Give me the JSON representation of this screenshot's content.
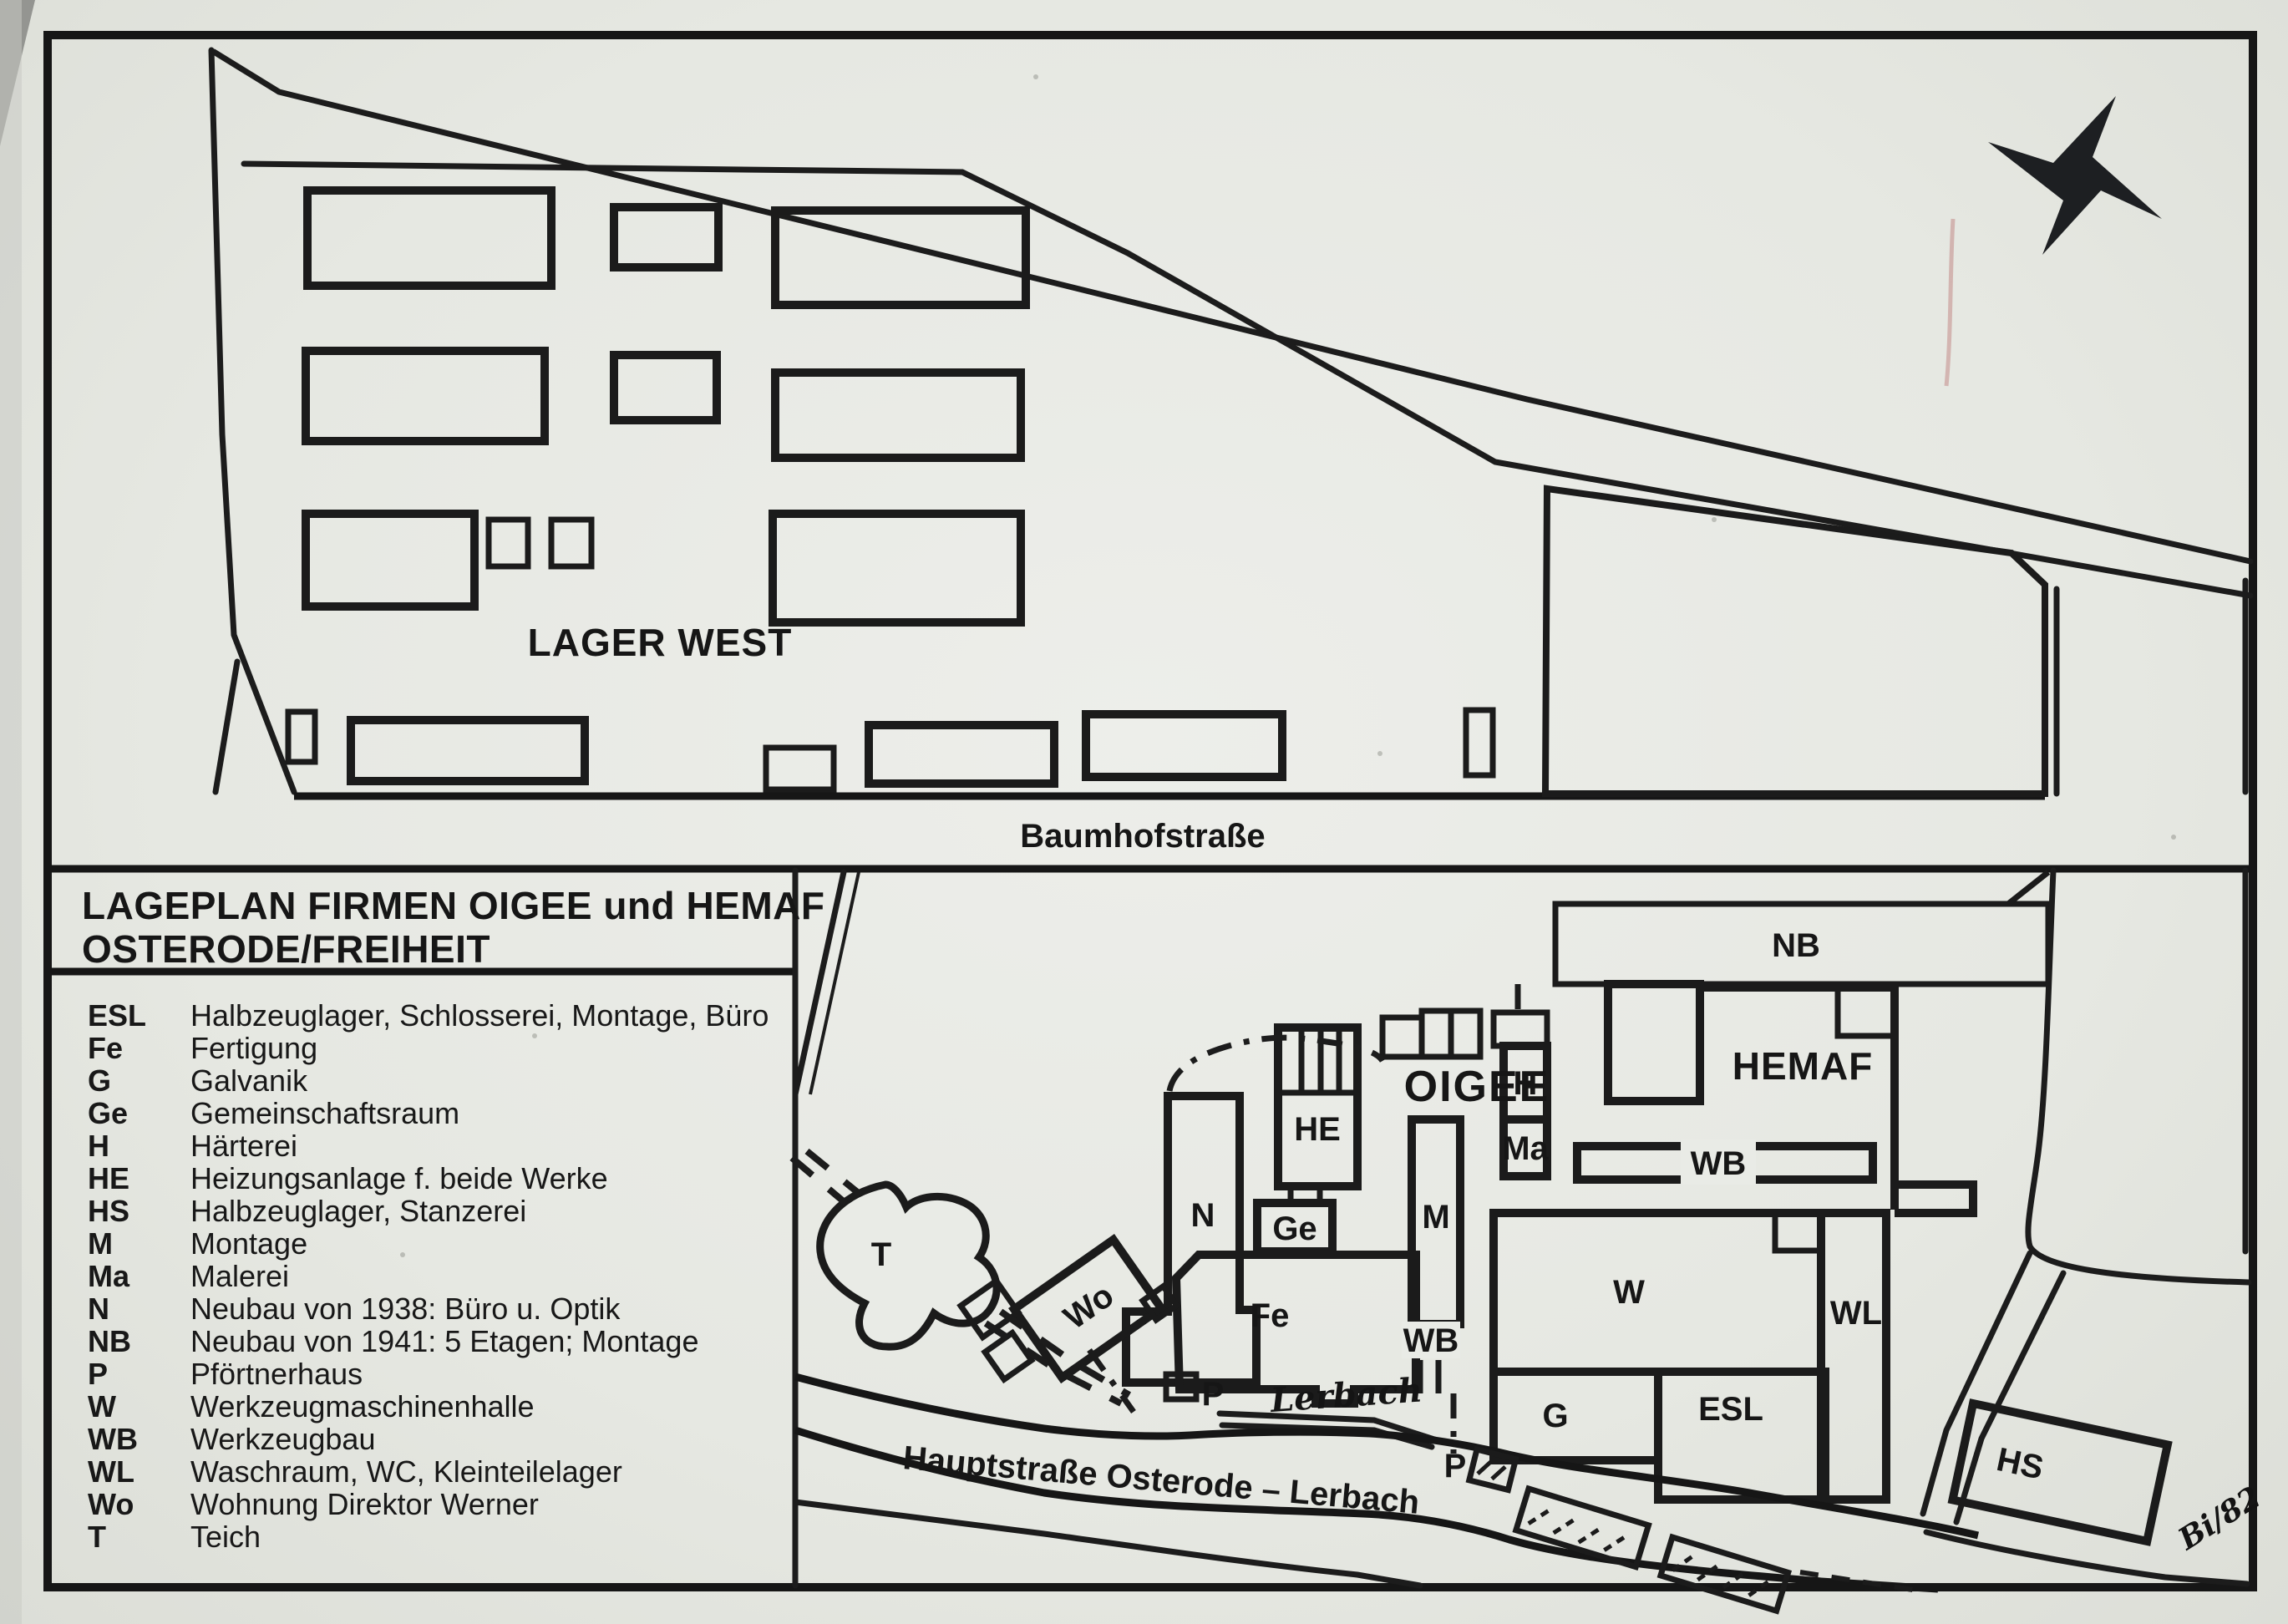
{
  "map": {
    "title_line1": "LAGEPLAN FIRMEN OIGEE und HEMAF",
    "title_line2": "OSTERODE/FREIHEIT",
    "areas": {
      "lager_west": "LAGER WEST"
    },
    "streets": {
      "baumhofstrasse": "Baumhofstraße",
      "hauptstrasse": "Hauptstraße Osterode – Lerbach",
      "lerbach_stream": "Lerbach"
    },
    "companies": {
      "oigee": "OIGEE",
      "hemaf": "HEMAF"
    },
    "building_labels": {
      "nb": "NB",
      "n": "N",
      "he": "HE",
      "ge": "Ge",
      "fe": "Fe",
      "m": "M",
      "h": "H",
      "ma": "Ma",
      "wb_oigee": "WB",
      "wb_hemaf": "WB",
      "w": "W",
      "wl": "WL",
      "g": "G",
      "esl": "ESL",
      "hs": "HS",
      "t": "T",
      "wo": "Wo",
      "p_gate1": "P",
      "p_gate2": "P"
    },
    "annotation_signature": "Bi/82"
  },
  "legend": {
    "items": [
      {
        "abbr": "ESL",
        "desc": "Halbzeuglager, Schlosserei, Montage, Büro"
      },
      {
        "abbr": "Fe",
        "desc": "Fertigung"
      },
      {
        "abbr": "G",
        "desc": "Galvanik"
      },
      {
        "abbr": "Ge",
        "desc": "Gemeinschaftsraum"
      },
      {
        "abbr": "H",
        "desc": "Härterei"
      },
      {
        "abbr": "HE",
        "desc": "Heizungsanlage f. beide Werke"
      },
      {
        "abbr": "HS",
        "desc": "Halbzeuglager, Stanzerei"
      },
      {
        "abbr": "M",
        "desc": "Montage"
      },
      {
        "abbr": "Ma",
        "desc": "Malerei"
      },
      {
        "abbr": "N",
        "desc": "Neubau von 1938: Büro u. Optik"
      },
      {
        "abbr": "NB",
        "desc": "Neubau von 1941: 5 Etagen; Montage"
      },
      {
        "abbr": "P",
        "desc": "Pförtnerhaus"
      },
      {
        "abbr": "W",
        "desc": "Werkzeugmaschinenhalle"
      },
      {
        "abbr": "WB",
        "desc": "Werkzeugbau"
      },
      {
        "abbr": "WL",
        "desc": "Waschraum, WC, Kleinteilelager"
      },
      {
        "abbr": "Wo",
        "desc": "Wohnung Direktor Werner"
      },
      {
        "abbr": "T",
        "desc": "Teich"
      }
    ]
  },
  "colors": {
    "ink": "#1b1b1b",
    "paper": "#e8eae5",
    "artifact_red": "#b05555"
  }
}
